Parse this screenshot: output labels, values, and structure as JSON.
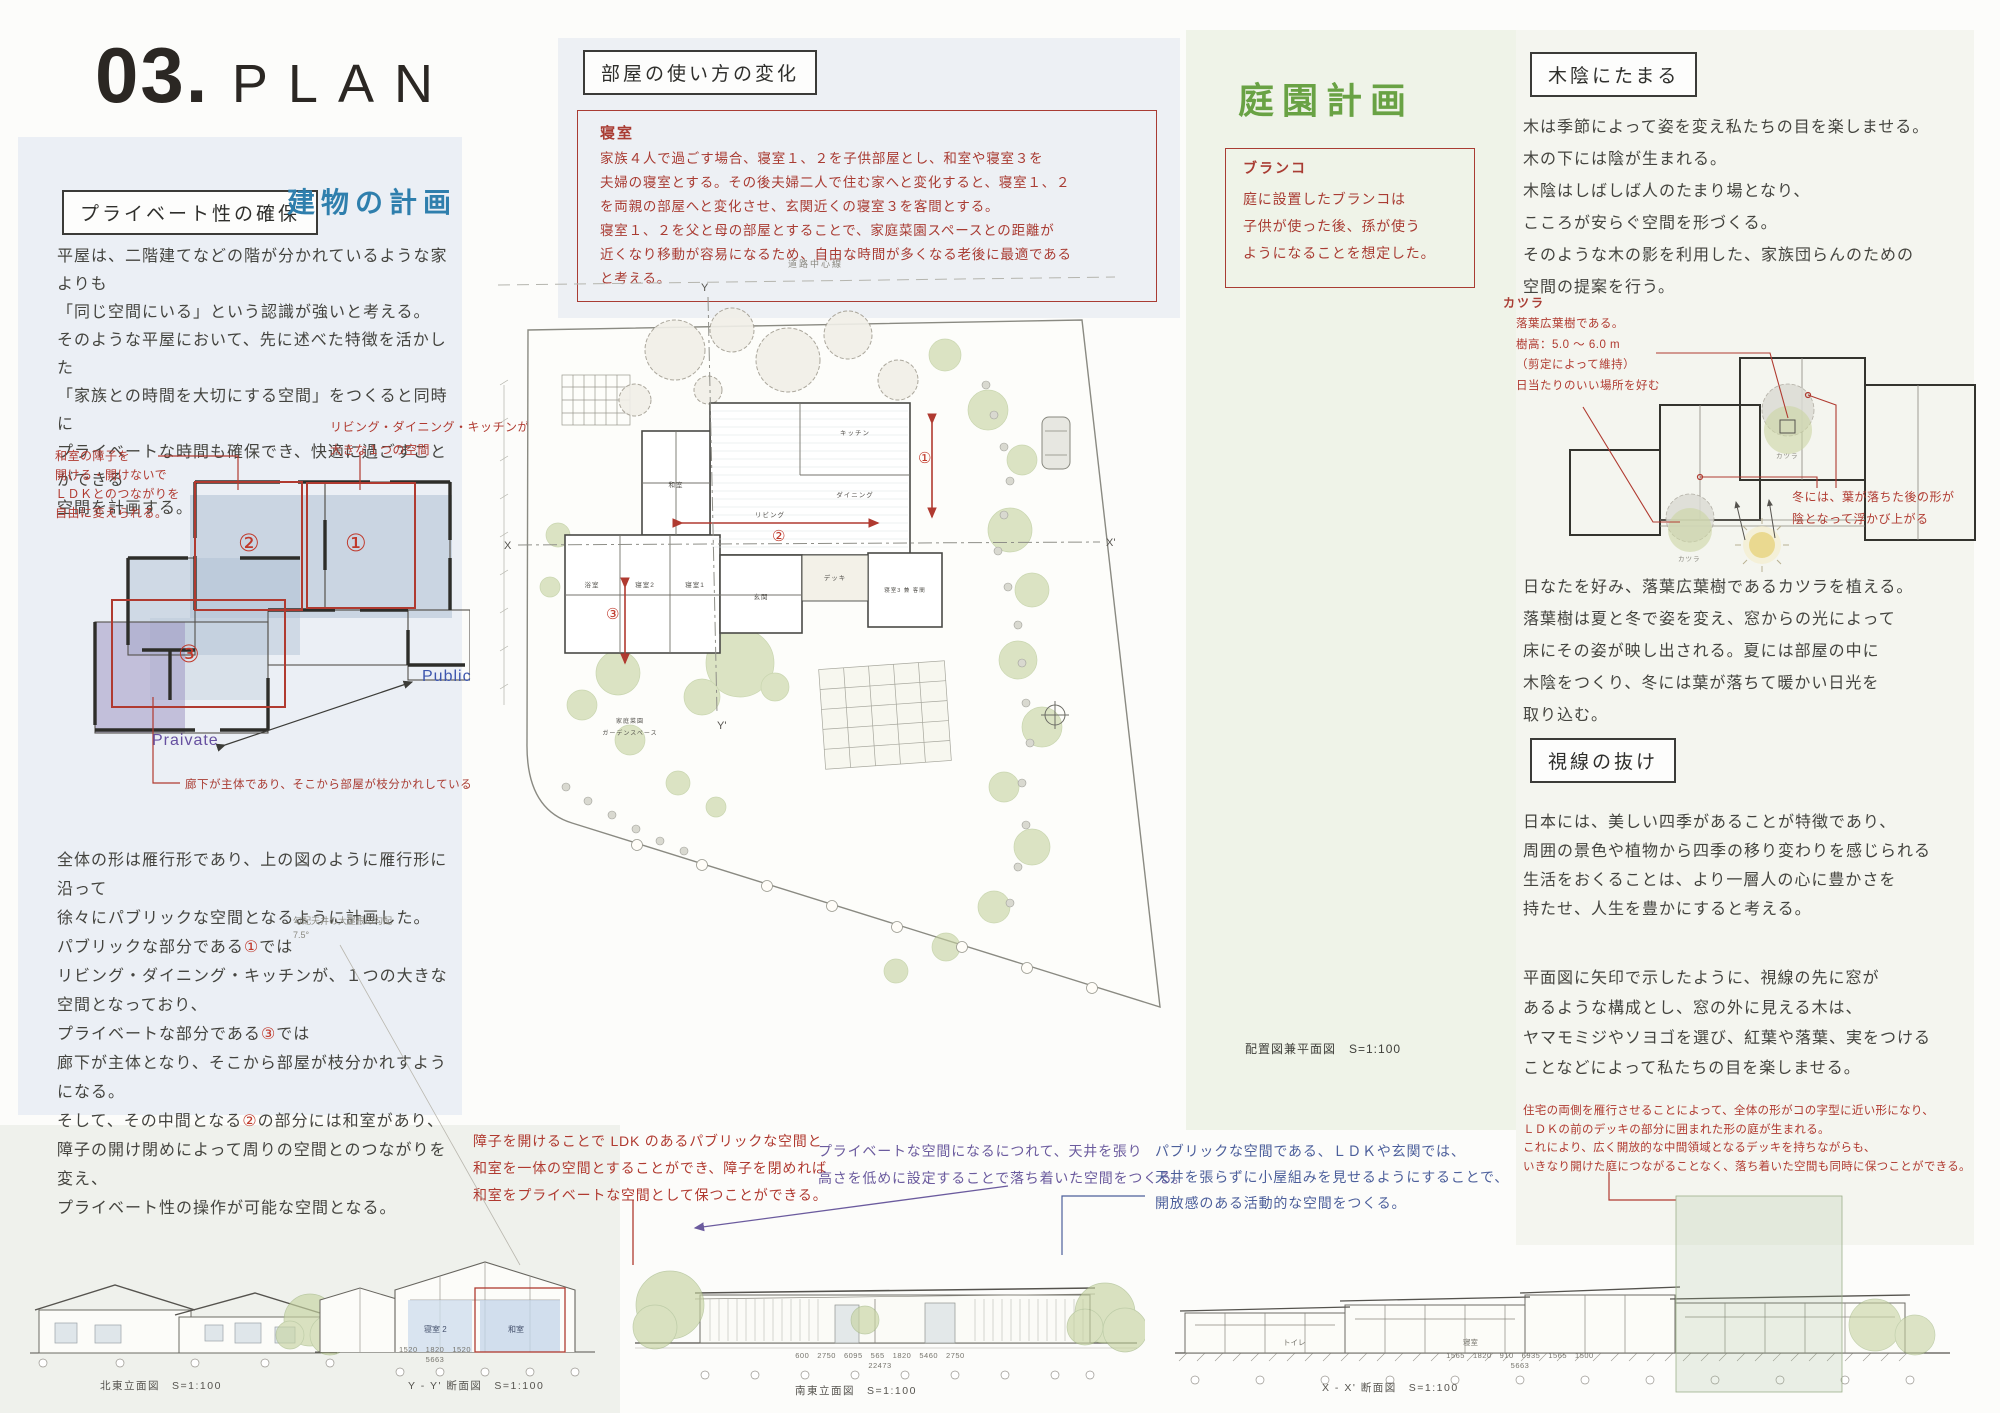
{
  "header": {
    "number": "03.",
    "title": "PLAN"
  },
  "building": {
    "box_title": "プライベート性の確保",
    "blue_title": "建物の計画",
    "para1": "平屋は、二階建てなどの階が分かれているような家よりも\n「同じ空間にいる」という認識が強いと考える。\nそのような平屋において、先に述べた特徴を活かした\n「家族との時間を大切にする空間」をつくると同時に\nプライベートな時間も確保でき、快適に過ごすことができる\n空間を計画する。",
    "ann_shoji": "和室の障子を\n開ける・開けないで\nＬＤＫとのつながりを\n自由に変えられる。",
    "ann_ldk": "リビング・ダイニング・キッチンがある\n大きな１つの空間",
    "ann_hallway": "廊下が主体であり、そこから部屋が枝分かれしている",
    "label_public": "Public",
    "label_private": "Praivate",
    "num1": "①",
    "num2": "②",
    "num3": "③",
    "para2_a": "全体の形は雁行形であり、上の図のように雁行形に沿って\n徐々にパブリックな空間となるように計画した。\nパブリックな部分である",
    "para2_n1": "①",
    "para2_b": "では\nリビング・ダイニング・キッチンが、１つの大きな\n空間となっており、\nプライベートな部分である",
    "para2_n3": "③",
    "para2_c": "では\n廊下が主体となり、そこから部屋が枝分かれすようになる。\nそして、その中間となる",
    "para2_n2": "②",
    "para2_d": "の部分には和室があり、\n障子の開け閉めによって周りの空間とのつながりを変え、\nプライベート性の操作が可能な空間となる。"
  },
  "room_usage": {
    "box_title": "部屋の使い方の変化",
    "label": "寝室",
    "body": "家族４人で過ごす場合、寝室１、２を子供部屋とし、和室や寝室３を\n夫婦の寝室とする。その後夫婦二人で住む家へと変化すると、寝室１、２\nを両親の部屋へと変化させ、玄関近くの寝室３を客間とする。\n寝室１、２を父と母の部屋とすることで、家庭菜園スペースとの距離が\n近くなり移動が容易になるため、自由な時間が多くなる老後に最適である\nと考える。"
  },
  "garden": {
    "title": "庭園計画",
    "box_label": "ブランコ",
    "box_body": "庭に設置したブランコは\n子供が使った後、孫が使う\nようになることを想定した。"
  },
  "site": {
    "caption": "配置図兼平面図　S=1:100",
    "road": "道路中心線",
    "x": "X",
    "x2": "X'",
    "y": "Y",
    "y2": "Y'",
    "rooms": {
      "washitsu": "和室",
      "kitchen": "キッチン",
      "dining": "ダイニング",
      "living": "リビング",
      "guest": "寝室3 兼 客間",
      "bed1": "寝室1",
      "bed2": "寝室2",
      "bath": "浴室",
      "entrance": "玄関",
      "deck": "デッキ",
      "garden1": "家庭菜園",
      "garden2": "ガーデンスペース"
    }
  },
  "shade": {
    "box_title": "木陰にたまる",
    "para1": "木は季節によって姿を変え私たちの目を楽しませる。\n木の下には陰が生まれる。\n木陰はしばしば人のたまり場となり、\nこころが安らぐ空間を形づくる。\nそのような木の影を利用した、家族団らんのための\n空間の提案を行う。",
    "katsura_label": "カツラ",
    "katsura_note": "落葉広葉樹である。\n樹高：5.0 〜 6.0 m\n（剪定によって維持）\n日当たりのいい場所を好む",
    "winter_note": "冬には、葉が落ちた後の形が\n陰となって浮かび上がる",
    "tree_label1": "カツラ",
    "tree_label2": "カツラ",
    "para2": "日なたを好み、落葉広葉樹であるカツラを植える。\n落葉樹は夏と冬で姿を変え、窓からの光によって\n床にその姿が映し出される。夏には部屋の中に\n木陰をつくり、冬には葉が落ちて暖かい日光を\n取り込む。"
  },
  "sight": {
    "box_title": "視線の抜け",
    "para1": "日本には、美しい四季があることが特徴であり、\n周囲の景色や植物から四季の移り変わりを感じられる\n生活をおくることは、より一層人の心に豊かさを\n持たせ、人生を豊かにすると考える。",
    "para2": "平面図に矢印で示したように、視線の先に窓が\nあるような構成とし、窓の外に見える木は、\nヤマモミジやソヨゴを選び、紅葉や落葉、実をつける\nことなどによって私たちの目を楽しませる。",
    "red_note": "住宅の両側を雁行させることによって、全体の形がコの字型に近い形になり、\nＬＤＫの前のデッキの部分に囲まれた形の庭が生まれる。\nこれにより、広く開放的な中間領域となるデッキを持ちながらも、\nいきなり開けた庭につながることなく、落ち着いた空間も同時に保つことができる。"
  },
  "section_notes": {
    "shoji": "障子を開けることで LDK のあるパブリックな空間と\n和室を一体の空間とすることができ、障子を閉めれば\n和室をプライベートな空間として保つことができる。",
    "private_note": "プライベートな空間になるにつれて、天井を張り\n高さを低めに設定することで落ち着いた空間をつくる。",
    "public_note": "パブリックな空間である、ＬＤＫや玄関では、\n天井を張らずに小屋組みを見せるようにすることで、\n開放感のある活動的な空間をつくる。",
    "roof_note": "勾配天井の大屋根の勾配\n7.5°"
  },
  "drawings": {
    "ne_caption": "北東立面図　S=1:100",
    "yy_caption": "Y - Y' 断面図　S=1:100",
    "se_caption": "南東立面図　S=1:100",
    "xx_caption": "X - X' 断面図　S=1:100",
    "yy_room1": "寝室 2",
    "yy_room2": "和室",
    "yy_dims": "1520　1820　1520",
    "yy_total": "5663",
    "se_dims": "600　2750　6095　565　1820　5460　2750",
    "se_total": "22473",
    "xx_dims": "1565　1820　910　6935　1565　1500",
    "xx_total": "5663",
    "xx_room1": "トイレ",
    "xx_room2": "寝室"
  },
  "colors": {
    "accent_red": "#a93c33",
    "accent_blue": "#2f7fad",
    "accent_green": "#69a244",
    "purple": "#6b5b9e",
    "public_blue": "#4c5f9b",
    "overlay_blue": "#aebfd2",
    "overlay_purple": "#9a8fc0"
  }
}
